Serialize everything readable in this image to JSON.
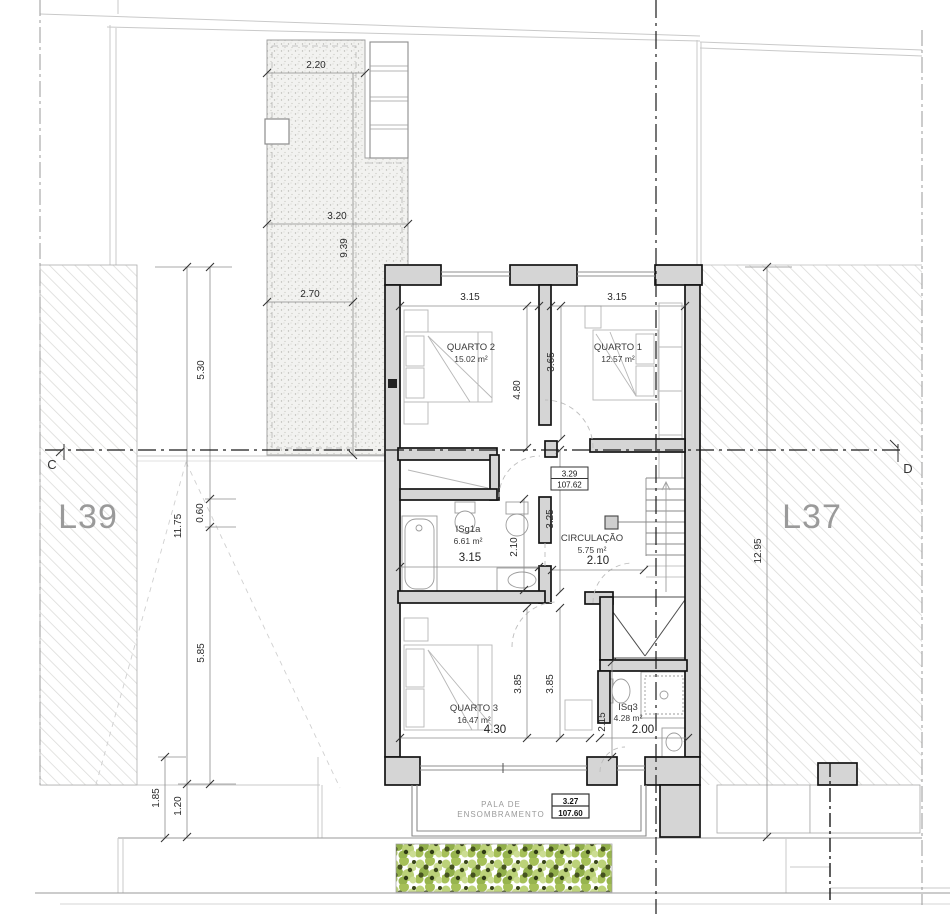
{
  "plan": {
    "lots": {
      "left": "L39",
      "right": "L37"
    },
    "sections": {
      "left": "C",
      "right": "D"
    },
    "rooms": {
      "quarto2": {
        "name": "QUARTO 2",
        "area": "15.02 m²",
        "width": "3.15",
        "depth": "4.80"
      },
      "quarto1": {
        "name": "QUARTO 1",
        "area": "12.57 m²",
        "width": "3.15",
        "depth": "3.65"
      },
      "isg1a": {
        "name": "ISg1a",
        "area": "6.61 m²",
        "width": "3.15",
        "depth": "2.10"
      },
      "circulacao": {
        "name": "CIRCULAÇÃO",
        "area": "5.75 m²",
        "width": "2.10"
      },
      "quarto3": {
        "name": "QUARTO 3",
        "area": "16.47 m²",
        "width": "4.30",
        "depth1": "3.85",
        "depth2": "3.85"
      },
      "isq3": {
        "name": "ISq3",
        "area": "4.28 m²",
        "width": "2.00",
        "depth": "2.15"
      }
    },
    "levels": {
      "upper": {
        "value": "3.29",
        "elevation": "107.62"
      },
      "lower": {
        "value": "3.27",
        "elevation": "107.60"
      }
    },
    "canopy": {
      "line1": "PALA DE",
      "line2": "ENSOMBRAMENTO"
    },
    "site_dims": {
      "patio_top": "2.20",
      "patio_mid": "3.20",
      "patio_height": "9.39",
      "patio_low": "2.70",
      "left_upper": "5.30",
      "left_total": "11.75",
      "left_small": "0.60",
      "left_lower": "5.85",
      "left_bottom1": "1.85",
      "left_bottom2": "1.20",
      "right_total": "12.95",
      "mid_band": "3.25"
    }
  }
}
